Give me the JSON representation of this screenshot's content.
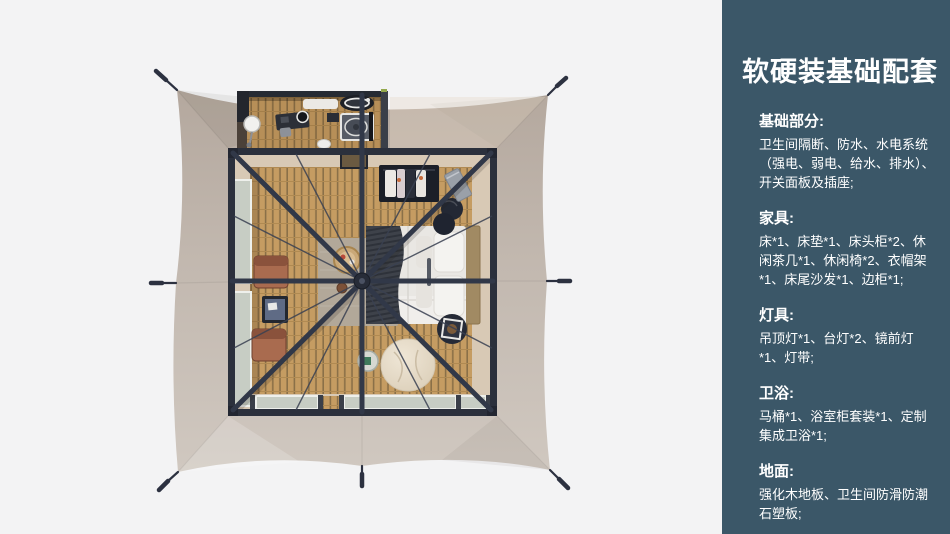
{
  "sidebar": {
    "title": "软硬装基础配套",
    "sections": [
      {
        "heading": "基础部分:",
        "body": "卫生间隔断、防水、水电系统（强电、弱电、给水、排水）、开关面板及插座;"
      },
      {
        "heading": "家具:",
        "body": "床*1、床垫*1、床头柜*2、休闲茶几*1、休闲椅*2、衣帽架*1、床尾沙发*1、边柜*1;"
      },
      {
        "heading": "灯具:",
        "body": "吊顶灯*1、台灯*2、镜前灯*1、灯带;"
      },
      {
        "heading": "卫浴:",
        "body": "马桶*1、浴室柜套装*1、定制集成卫浴*1;"
      },
      {
        "heading": "地面:",
        "body": "强化木地板、卫生间防滑防潮石塑板;"
      }
    ]
  },
  "floorplan": {
    "type": "top-down-tent-render",
    "rooms": [
      "bedroom",
      "bathroom-annex"
    ],
    "furniture": [
      "bed",
      "pillows",
      "throw-blanket",
      "nightstand-poufs",
      "clothes-rack",
      "side-cabinet",
      "bedside-tray-table",
      "rug",
      "woven-tray",
      "lounge-chair-1",
      "lounge-chair-2",
      "tea-table",
      "bean-bag",
      "round-side-table",
      "vanity-desk",
      "sink",
      "shower",
      "toilet",
      "standing-mirror"
    ]
  },
  "colors": {
    "page_bg": "#f3f3f4",
    "sidebar_bg": "#3b5768",
    "sidebar_text": "#ffffff",
    "tent_canvas": "#c2b8af",
    "frame_dark": "#2b303c",
    "wood_floor": "#c59c62",
    "wood_gap": "#8a7048",
    "interior_beige": "#d8c9b5",
    "rug": "#b2a899",
    "chair_terracotta": "#a96b4f",
    "bedding_white": "#e9e7e3",
    "throw_dark": "#3e424a",
    "glass": "#c7cdc4",
    "bean_bag": "#e4d9c6"
  }
}
